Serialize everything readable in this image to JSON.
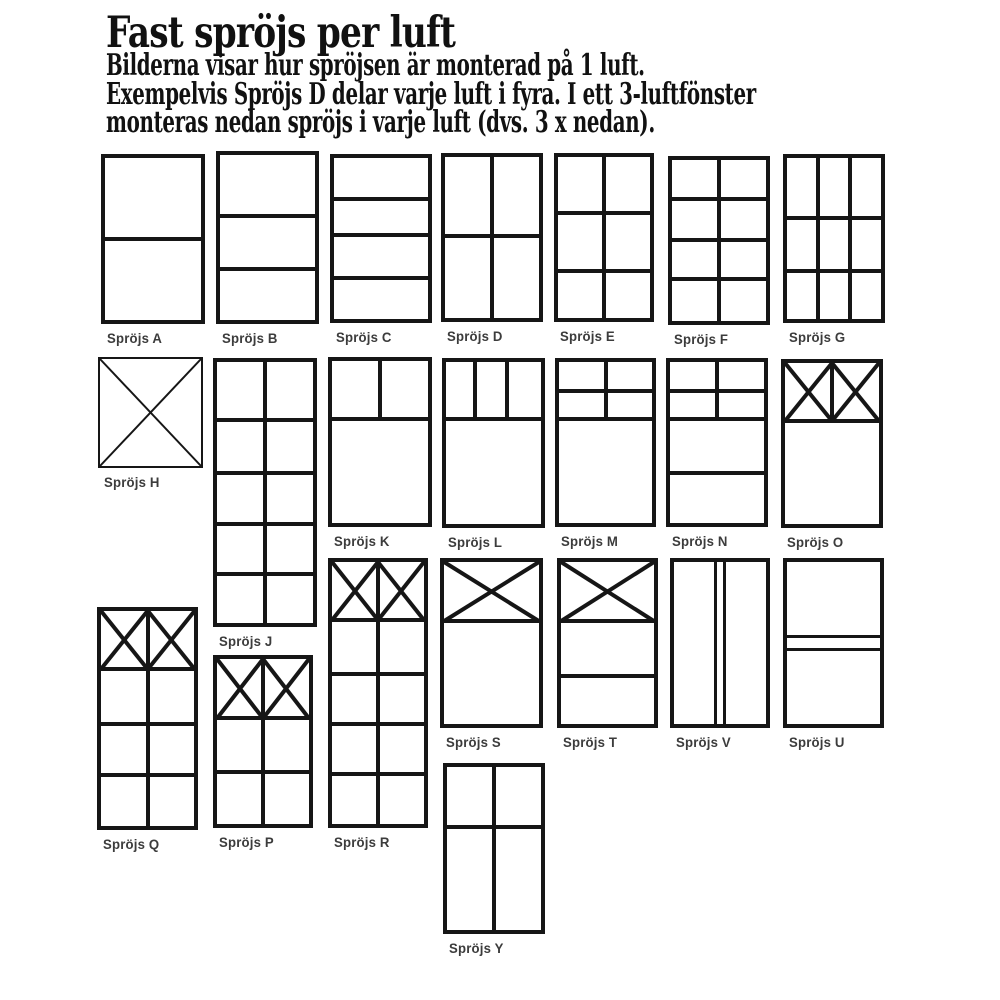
{
  "title": "Fast spröjs per luft",
  "intro_lines": [
    "Bilderna visar hur spröjsen är monterad på 1 luft.",
    "Exempelvis Spröjs D delar varje luft i fyra. I ett 3-luftfönster",
    "monteras nedan spröjs i varje luft (dvs. 3 x nedan)."
  ],
  "colors": {
    "line": "#161616",
    "label_text": "#3c3c3c",
    "body_text": "#111111",
    "background": "#ffffff"
  },
  "windows": [
    {
      "id": "A",
      "label": "Spröjs A",
      "frame": [
        101,
        154,
        104,
        170
      ],
      "h": [
        [
          0.5,
          0,
          1
        ]
      ],
      "v": [],
      "crosses": []
    },
    {
      "id": "B",
      "label": "Spröjs B",
      "frame": [
        216,
        151,
        103,
        173
      ],
      "h": [
        [
          0.37,
          0,
          1
        ],
        [
          0.693,
          0,
          1
        ]
      ],
      "v": [],
      "crosses": []
    },
    {
      "id": "C",
      "label": "Spröjs C",
      "frame": [
        330,
        154,
        102,
        169
      ],
      "h": [
        [
          0.254,
          0,
          1
        ],
        [
          0.479,
          0,
          1
        ],
        [
          0.745,
          0,
          1
        ]
      ],
      "v": [],
      "crosses": []
    },
    {
      "id": "D",
      "label": "Spröjs D",
      "frame": [
        441,
        153,
        102,
        169
      ],
      "h": [
        [
          0.49,
          0,
          1
        ]
      ],
      "v": [
        [
          0.5,
          0,
          1
        ]
      ],
      "crosses": []
    },
    {
      "id": "E",
      "label": "Spröjs E",
      "frame": [
        554,
        153,
        100,
        169
      ],
      "h": [
        [
          0.35,
          0,
          1
        ],
        [
          0.71,
          0,
          1
        ]
      ],
      "v": [
        [
          0.5,
          0,
          1
        ]
      ],
      "crosses": []
    },
    {
      "id": "F",
      "label": "Spröjs F",
      "frame": [
        668,
        156,
        102,
        169
      ],
      "h": [
        [
          0.243,
          0,
          1
        ],
        [
          0.497,
          0,
          1
        ],
        [
          0.74,
          0,
          1
        ]
      ],
      "v": [
        [
          0.5,
          0,
          1
        ]
      ],
      "crosses": []
    },
    {
      "id": "G",
      "label": "Spröjs G",
      "frame": [
        783,
        154,
        102,
        169
      ],
      "h": [
        [
          0.373,
          0,
          1
        ],
        [
          0.704,
          0,
          1
        ]
      ],
      "v": [
        [
          0.333,
          0,
          1
        ],
        [
          0.667,
          0,
          1
        ]
      ],
      "crosses": []
    },
    {
      "id": "H",
      "label": "Spröjs H",
      "frame": [
        98,
        357,
        105,
        111
      ],
      "stroke": 2,
      "h": [],
      "v": [],
      "crosses": [
        [
          0,
          0,
          1,
          1
        ]
      ]
    },
    {
      "id": "J",
      "label": "Spröjs J",
      "frame": [
        213,
        358,
        104,
        269
      ],
      "h": [
        [
          0.223,
          0,
          1
        ],
        [
          0.424,
          0,
          1
        ],
        [
          0.621,
          0,
          1
        ],
        [
          0.814,
          0,
          1
        ]
      ],
      "v": [
        [
          0.5,
          0,
          1
        ]
      ],
      "crosses": []
    },
    {
      "id": "K",
      "label": "Spröjs K",
      "frame": [
        328,
        357,
        104,
        170
      ],
      "h": [
        [
          0.359,
          0,
          1
        ]
      ],
      "v": [
        [
          0.5,
          0,
          0.359
        ]
      ],
      "crosses": []
    },
    {
      "id": "L",
      "label": "Spröjs L",
      "frame": [
        442,
        358,
        103,
        170
      ],
      "h": [
        [
          0.353,
          0,
          1
        ]
      ],
      "v": [
        [
          0.3,
          0,
          0.353
        ],
        [
          0.64,
          0,
          0.353
        ]
      ],
      "crosses": []
    },
    {
      "id": "M",
      "label": "Spröjs M",
      "frame": [
        555,
        358,
        101,
        169
      ],
      "h": [
        [
          0.178,
          0,
          1
        ],
        [
          0.355,
          0,
          1
        ]
      ],
      "v": [
        [
          0.5,
          0,
          0.355
        ]
      ],
      "crosses": []
    },
    {
      "id": "N",
      "label": "Spröjs N",
      "frame": [
        666,
        358,
        102,
        169
      ],
      "h": [
        [
          0.183,
          0,
          1
        ],
        [
          0.355,
          0,
          1
        ],
        [
          0.692,
          0,
          1
        ]
      ],
      "v": [
        [
          0.5,
          0,
          0.355
        ]
      ],
      "crosses": []
    },
    {
      "id": "O",
      "label": "Spröjs O",
      "frame": [
        781,
        359,
        102,
        169
      ],
      "h": [
        [
          0.36,
          0,
          1
        ]
      ],
      "v": [
        [
          0.5,
          0,
          0.36
        ]
      ],
      "crosses": [
        [
          0,
          0,
          0.5,
          0.36
        ],
        [
          0.5,
          0,
          0.5,
          0.36
        ]
      ]
    },
    {
      "id": "Q",
      "label": "Spröjs Q",
      "frame": [
        97,
        607,
        101,
        223
      ],
      "h": [
        [
          0.27,
          0,
          1
        ],
        [
          0.525,
          0,
          1
        ],
        [
          0.765,
          0,
          1
        ]
      ],
      "v": [
        [
          0.5,
          0,
          1
        ]
      ],
      "crosses": [
        [
          0,
          0,
          0.5,
          0.27
        ],
        [
          0.5,
          0,
          0.5,
          0.27
        ]
      ]
    },
    {
      "id": "P",
      "label": "Spröjs P",
      "frame": [
        213,
        655,
        100,
        173
      ],
      "h": [
        [
          0.36,
          0,
          1
        ],
        [
          0.685,
          0,
          1
        ]
      ],
      "v": [
        [
          0.5,
          0,
          1
        ]
      ],
      "crosses": [
        [
          0,
          0,
          0.5,
          0.36
        ],
        [
          0.5,
          0,
          0.5,
          0.36
        ]
      ]
    },
    {
      "id": "R",
      "label": "Spröjs R",
      "frame": [
        328,
        558,
        100,
        270
      ],
      "h": [
        [
          0.222,
          0,
          1
        ],
        [
          0.426,
          0,
          1
        ],
        [
          0.619,
          0,
          1
        ],
        [
          0.811,
          0,
          1
        ]
      ],
      "v": [
        [
          0.5,
          0,
          1
        ]
      ],
      "crosses": [
        [
          0,
          0,
          0.5,
          0.222
        ],
        [
          0.5,
          0,
          0.5,
          0.222
        ]
      ]
    },
    {
      "id": "S",
      "label": "Spröjs S",
      "frame": [
        440,
        558,
        103,
        170
      ],
      "h": [
        [
          0.365,
          0,
          1
        ]
      ],
      "v": [],
      "crosses": [
        [
          0,
          0,
          1,
          0.365
        ]
      ]
    },
    {
      "id": "T",
      "label": "Spröjs T",
      "frame": [
        557,
        558,
        101,
        170
      ],
      "h": [
        [
          0.365,
          0,
          1
        ],
        [
          0.706,
          0,
          1
        ]
      ],
      "v": [],
      "crosses": [
        [
          0,
          0,
          1,
          0.365
        ]
      ]
    },
    {
      "id": "V",
      "label": "Spröjs V",
      "frame": [
        670,
        558,
        100,
        170
      ],
      "h": [],
      "v": [
        [
          0.451,
          0,
          1,
          3
        ],
        [
          0.549,
          0,
          1,
          3
        ]
      ],
      "crosses": []
    },
    {
      "id": "U",
      "label": "Spröjs U",
      "frame": [
        783,
        558,
        101,
        170
      ],
      "h": [
        [
          0.457,
          0,
          1,
          3
        ],
        [
          0.543,
          0,
          1,
          3
        ]
      ],
      "v": [],
      "crosses": []
    },
    {
      "id": "Y",
      "label": "Spröjs Y",
      "frame": [
        443,
        763,
        102,
        171
      ],
      "h": [
        [
          0.368,
          0,
          1
        ]
      ],
      "v": [
        [
          0.5,
          0,
          1
        ]
      ],
      "crosses": []
    }
  ]
}
